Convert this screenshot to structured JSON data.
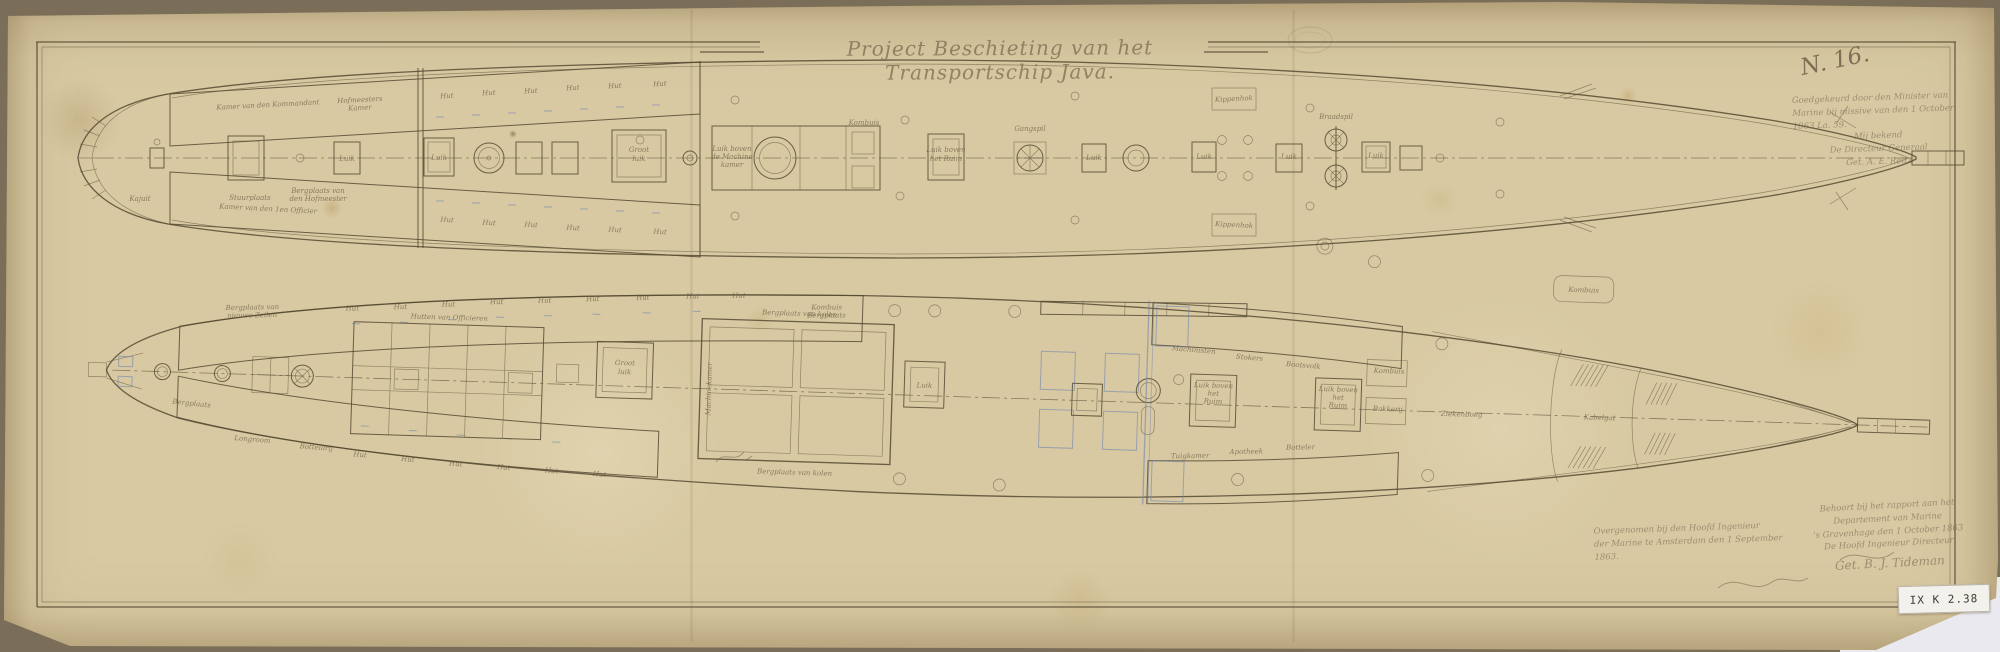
{
  "document": {
    "title": "Project Beschieting van het Transportschip Java.",
    "sheet_no": "N. 16.",
    "archive_sticker": "IX K 2.38",
    "paper_color": "#d8c9a2",
    "ink_color": "#564a33",
    "blue_ink": "#7286b0"
  },
  "annotations": {
    "approval": {
      "lines": [
        "Goedgekeurd door den Minister van",
        "Marine bij missive van den 1 October",
        "1863  La. 59.",
        "Mij bekend",
        "De Directeur Generaal",
        "Get. A. E. Reitz"
      ]
    },
    "made_by": {
      "lines": [
        "Behoort bij het rapport aan het",
        "Departement van Marine",
        "'s Gravenhage den 1 October 1863",
        "De Hoofd Ingenieur Directeur",
        "Get. B. J. Tideman"
      ]
    },
    "seen_by": {
      "lines": [
        "Overgenomen bij den Hoofd Ingenieur",
        "der Marine te Amsterdam den 1 September",
        "1863."
      ]
    }
  },
  "upper_deck": {
    "labels": [
      {
        "t": "Kajuit",
        "x": 140,
        "y": 201,
        "s": 7
      },
      {
        "t": "Stuurplaats",
        "x": 250,
        "y": 200,
        "s": 7
      },
      {
        "t": "Bergplaats van",
        "x": 318,
        "y": 193,
        "s": 5.5
      },
      {
        "t": "den Hofmeester",
        "x": 318,
        "y": 201,
        "s": 5.5
      },
      {
        "t": "Kamer van den Kommandant",
        "x": 268,
        "y": 107,
        "s": 5.5,
        "r": -3
      },
      {
        "t": "Hofmeesters",
        "x": 360,
        "y": 102,
        "s": 5.5,
        "r": -3
      },
      {
        "t": "Kamer",
        "x": 360,
        "y": 110,
        "s": 5.5,
        "r": -3
      },
      {
        "t": "Hut",
        "x": 447,
        "y": 98,
        "s": 7,
        "r": -3
      },
      {
        "t": "Hut",
        "x": 489,
        "y": 95,
        "s": 7,
        "r": -3
      },
      {
        "t": "Hut",
        "x": 531,
        "y": 93,
        "s": 7,
        "r": -3
      },
      {
        "t": "Hut",
        "x": 573,
        "y": 90,
        "s": 7,
        "r": -3
      },
      {
        "t": "Hut",
        "x": 615,
        "y": 88,
        "s": 7,
        "r": -3
      },
      {
        "t": "Hut",
        "x": 660,
        "y": 86,
        "s": 7,
        "r": -3
      },
      {
        "t": "Kamer van den 1en Officier",
        "x": 268,
        "y": 211,
        "s": 5.5,
        "r": 3
      },
      {
        "t": "Hut",
        "x": 447,
        "y": 222,
        "s": 7,
        "r": 3
      },
      {
        "t": "Hut",
        "x": 489,
        "y": 225,
        "s": 7,
        "r": 3
      },
      {
        "t": "Hut",
        "x": 531,
        "y": 227,
        "s": 7,
        "r": 3
      },
      {
        "t": "Hut",
        "x": 573,
        "y": 230,
        "s": 7,
        "r": 3
      },
      {
        "t": "Hut",
        "x": 615,
        "y": 232,
        "s": 7,
        "r": 3
      },
      {
        "t": "Hut",
        "x": 660,
        "y": 234,
        "s": 7,
        "r": 3
      },
      {
        "t": "Luik",
        "x": 347,
        "y": 161,
        "s": 5.5
      },
      {
        "t": "Luik",
        "x": 439,
        "y": 160,
        "s": 5.5
      },
      {
        "t": "Groot",
        "x": 639,
        "y": 152,
        "s": 6
      },
      {
        "t": "luik",
        "x": 639,
        "y": 161,
        "s": 6
      },
      {
        "t": "Luik boven",
        "x": 732,
        "y": 151,
        "s": 5.5
      },
      {
        "t": "de Machine",
        "x": 732,
        "y": 159,
        "s": 5.5
      },
      {
        "t": "kamer",
        "x": 732,
        "y": 167,
        "s": 5.5
      },
      {
        "t": "Luik boven",
        "x": 946,
        "y": 152,
        "s": 5.5
      },
      {
        "t": "het Ruim",
        "x": 946,
        "y": 161,
        "s": 5.5
      },
      {
        "t": "Gangspil",
        "x": 1030,
        "y": 131,
        "s": 6
      },
      {
        "t": "Luik",
        "x": 1094,
        "y": 160,
        "s": 5.5
      },
      {
        "t": "Luik",
        "x": 1204,
        "y": 159,
        "s": 5.5
      },
      {
        "t": "Luik",
        "x": 1289,
        "y": 159,
        "s": 5.5
      },
      {
        "t": "Braadspil",
        "x": 1336,
        "y": 119,
        "s": 6
      },
      {
        "t": "Luik",
        "x": 1376,
        "y": 158,
        "s": 5.5
      },
      {
        "t": "Kippenhok",
        "x": 1234,
        "y": 101,
        "s": 5.5,
        "r": -3
      },
      {
        "t": "Kippenhok",
        "x": 1234,
        "y": 227,
        "s": 5.5,
        "r": 3
      },
      {
        "t": "Kombuis",
        "x": 864,
        "y": 125,
        "s": 5
      }
    ]
  },
  "lower_deck": {
    "labels": [
      {
        "t": "Bergplaats van",
        "x": 250,
        "y": 333,
        "s": 5.5,
        "r": -3
      },
      {
        "t": "nieuwe Zeilen",
        "x": 250,
        "y": 341,
        "s": 5.5,
        "r": -3
      },
      {
        "t": "Hut",
        "x": 350,
        "y": 331,
        "s": 7,
        "r": -3
      },
      {
        "t": "Hut",
        "x": 398,
        "y": 328,
        "s": 7,
        "r": -3
      },
      {
        "t": "Hut",
        "x": 446,
        "y": 324,
        "s": 7,
        "r": -3
      },
      {
        "t": "Hut",
        "x": 494,
        "y": 320,
        "s": 7,
        "r": -3
      },
      {
        "t": "Hut",
        "x": 542,
        "y": 317,
        "s": 7,
        "r": -3
      },
      {
        "t": "Hut",
        "x": 590,
        "y": 314,
        "s": 7,
        "r": -3
      },
      {
        "t": "Hut",
        "x": 640,
        "y": 311,
        "s": 7,
        "r": -3
      },
      {
        "t": "Hut",
        "x": 690,
        "y": 308,
        "s": 7,
        "r": -3
      },
      {
        "t": "Hut",
        "x": 736,
        "y": 306,
        "s": 7,
        "r": -3
      },
      {
        "t": "Kombuis",
        "x": 824,
        "y": 315,
        "s": 5.5,
        "r": -2
      },
      {
        "t": "Bergplaats",
        "x": 824,
        "y": 323,
        "s": 5.5,
        "r": -2
      },
      {
        "t": "Longroom",
        "x": 254,
        "y": 465,
        "s": 6.5,
        "r": 3
      },
      {
        "t": "Bottelarij",
        "x": 318,
        "y": 471,
        "s": 6,
        "r": 3
      },
      {
        "t": "Hut",
        "x": 362,
        "y": 477,
        "s": 7,
        "r": 3
      },
      {
        "t": "Hut",
        "x": 410,
        "y": 480,
        "s": 7,
        "r": 3
      },
      {
        "t": "Hut",
        "x": 458,
        "y": 483,
        "s": 7,
        "r": 3
      },
      {
        "t": "Hut",
        "x": 506,
        "y": 485,
        "s": 7,
        "r": 3
      },
      {
        "t": "Hut",
        "x": 554,
        "y": 487,
        "s": 7,
        "r": 3
      },
      {
        "t": "Hut",
        "x": 602,
        "y": 489,
        "s": 7,
        "r": 3
      },
      {
        "t": "Hutten van Officieren",
        "x": 447,
        "y": 337,
        "s": 6
      },
      {
        "t": "Groot",
        "x": 624,
        "y": 377,
        "s": 6
      },
      {
        "t": "luik",
        "x": 624,
        "y": 386,
        "s": 6
      },
      {
        "t": "Bergplaats van kolen",
        "x": 797,
        "y": 322,
        "s": 6.5
      },
      {
        "t": "Bergplaats van kolen",
        "x": 797,
        "y": 481,
        "s": 6.5
      },
      {
        "t": "Machinekamer",
        "x": 711,
        "y": 398,
        "s": 6,
        "r": -90
      },
      {
        "t": "Luik",
        "x": 924,
        "y": 390,
        "s": 5.5
      },
      {
        "t": "Luik boven",
        "x": 1213,
        "y": 381,
        "s": 5.5
      },
      {
        "t": "het",
        "x": 1213,
        "y": 389,
        "s": 5.5
      },
      {
        "t": "Ruim",
        "x": 1213,
        "y": 397,
        "s": 5.5
      },
      {
        "t": "Luik boven",
        "x": 1338,
        "y": 381,
        "s": 5.5
      },
      {
        "t": "het",
        "x": 1338,
        "y": 389,
        "s": 5.5
      },
      {
        "t": "Ruim",
        "x": 1338,
        "y": 397,
        "s": 5.5
      },
      {
        "t": "Kombuis",
        "x": 1388,
        "y": 361,
        "s": 5.5
      },
      {
        "t": "Bakkerij",
        "x": 1388,
        "y": 399,
        "s": 5.5
      },
      {
        "t": "Machinisten",
        "x": 1192,
        "y": 346,
        "s": 5.5,
        "r": 3
      },
      {
        "t": "Stokers",
        "x": 1248,
        "y": 352,
        "s": 5.5,
        "r": 3
      },
      {
        "t": "Bootsvolk",
        "x": 1302,
        "y": 358,
        "s": 5.5,
        "r": 3
      },
      {
        "t": "Tuigkamer",
        "x": 1192,
        "y": 452,
        "s": 5.5,
        "r": -3
      },
      {
        "t": "Apotheek",
        "x": 1248,
        "y": 446,
        "s": 5.5,
        "r": -3
      },
      {
        "t": "Botteler",
        "x": 1302,
        "y": 440,
        "s": 5.5,
        "r": -3
      },
      {
        "t": "Ziekenboeg",
        "x": 1462,
        "y": 402,
        "s": 9
      },
      {
        "t": "Kabelgat",
        "x": 1600,
        "y": 401,
        "s": 6
      },
      {
        "t": "Bergplaats",
        "x": 192,
        "y": 431,
        "s": 5.5,
        "r": 4
      },
      {
        "t": "Kombuis",
        "x": 1580,
        "y": 274,
        "s": 5
      }
    ]
  }
}
